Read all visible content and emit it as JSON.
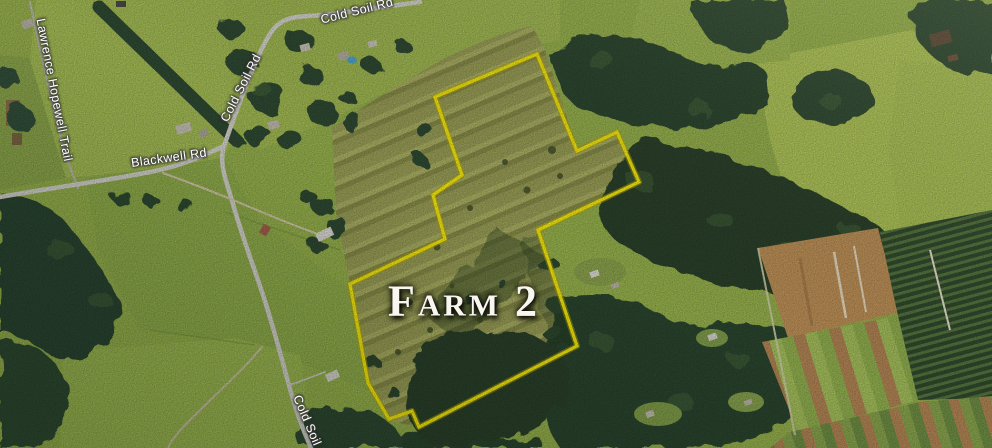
{
  "map": {
    "title": {
      "text": "Farm 2",
      "x": 464,
      "y": 301,
      "rotation": 0
    },
    "road_labels": [
      {
        "text": "Lawrence Hopewell Trail",
        "x": 54,
        "y": 90,
        "rotation": 79
      },
      {
        "text": "Blackwell Rd",
        "x": 169,
        "y": 158,
        "rotation": -8
      },
      {
        "text": "Cold Soil Rd",
        "x": 241,
        "y": 88,
        "rotation": -63
      },
      {
        "text": "Cold Soil Rd",
        "x": 357,
        "y": 11,
        "rotation": -14
      },
      {
        "text": "Cold Soil Rd",
        "x": 311,
        "y": 430,
        "rotation": 67
      }
    ],
    "boundary": {
      "label": "Farm 2 parcel boundary",
      "color": "#f4e70d",
      "points": [
        [
          435,
          97
        ],
        [
          537,
          54
        ],
        [
          577,
          151
        ],
        [
          617,
          132
        ],
        [
          639,
          182
        ],
        [
          538,
          230
        ],
        [
          577,
          346
        ],
        [
          419,
          427
        ],
        [
          412,
          411
        ],
        [
          389,
          419
        ],
        [
          368,
          383
        ],
        [
          350,
          284
        ],
        [
          445,
          239
        ],
        [
          433,
          195
        ],
        [
          462,
          175
        ]
      ]
    },
    "colors": {
      "boundary_yellow": "#f4e70d",
      "road_label_white": "#ffffff",
      "title_white": "#f8f6ee"
    }
  }
}
